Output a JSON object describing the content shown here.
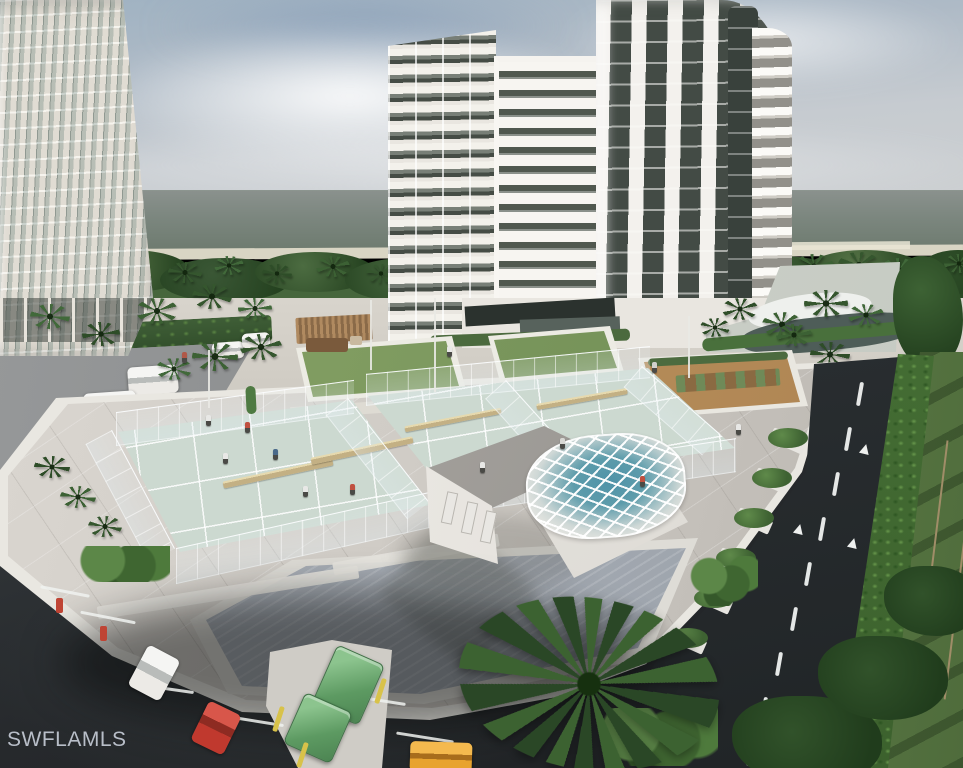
{
  "watermark": {
    "text": "SWFLAMLS"
  },
  "scene": {
    "type": "aerial-architectural-rendering",
    "alt": "Aerial rendering of a beachfront condominium community: two white high-rise towers by a gray-green gulf, a rooftop amenity deck with fenced pickleball courts, lawns, a white clubhouse with a blue spa under a white lattice dome, palm trees, a dark driveway with dashed markings and hedges, and a parking area with cars and green dumpsters."
  },
  "palette": {
    "sky_top": "#9fb2c2",
    "ocean": "#6d7a6e",
    "beach_sand": "#d9d5c4",
    "treeline_green": "#46663c",
    "plaza_concrete": "#d5d1c9",
    "deck_concrete": "#d0ccc6",
    "court_green": "#ccd9d0",
    "court_line": "#ffffff",
    "net_tan": "#c3b084",
    "lawn_green": "#6f8e55",
    "garden_sand": "#ab8150",
    "clubhouse_white": "#f3f1ed",
    "dome_blue": "#4f93a8",
    "asphalt_dark": "#26292c",
    "road_dark": "#2b3033",
    "road_marking": "#eff1f0",
    "hedge_green": "#4a7639",
    "grass_green": "#67874c",
    "tower_white": "#f3f1ed",
    "window_glass": "#434b45",
    "dumpster_green": "#5d9a62",
    "car_red": "#c0392e",
    "car_orange": "#e8a32e",
    "car_white": "#eceae6",
    "bollard_yellow": "#d8c24a",
    "bollard_red": "#bf4434",
    "watermark_gray": "#c5cbd6"
  }
}
